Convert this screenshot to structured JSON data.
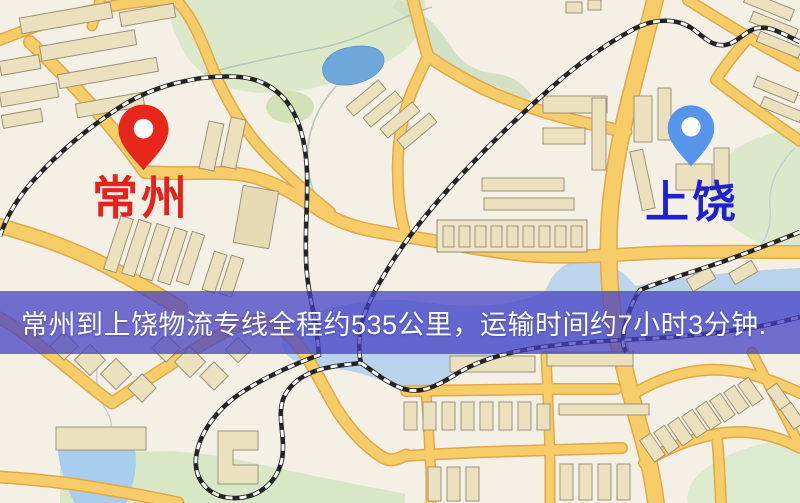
{
  "banner": {
    "text": "常州到上饶物流专线全程约535公里，运输时间约7小时3分钟.",
    "bg_color": "rgba(67,64,196,0.74)",
    "text_color": "#fcfcfc"
  },
  "markers": {
    "origin": {
      "label": "常州",
      "label_color": "#e8221a",
      "pin_color": "#e8261b"
    },
    "destination": {
      "label": "上饶",
      "label_color": "#2121cd",
      "pin_color": "#5795e9"
    }
  },
  "route": {
    "distance_km": "535",
    "duration": "7小时3分钟"
  },
  "map_colors": {
    "background": "#f4f0e6",
    "road_fill": "#f6cd68",
    "road_casing": "#e2a849",
    "park": "#dbe9ca",
    "water": "#b9d3ec",
    "lake": "#6fa7db",
    "building": "#ece1bf",
    "building_stroke": "#9c9279",
    "railway": "#242424"
  }
}
